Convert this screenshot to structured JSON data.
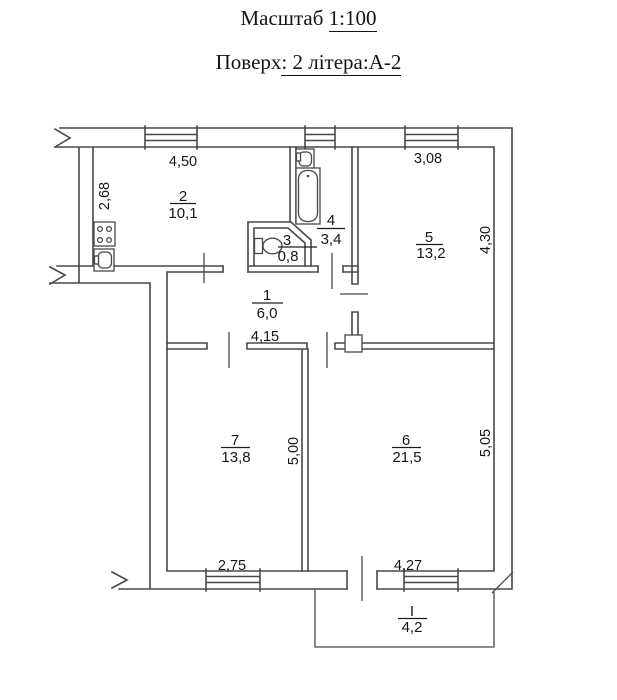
{
  "header": {
    "line1": {
      "prefix": "Масштаб",
      "underlined": "1:100"
    },
    "line2": {
      "prefix": "Поверх",
      "underlined": ": 2 літера:А-2"
    }
  },
  "rooms": [
    {
      "id": "hallway",
      "number": "1",
      "area": "6,0"
    },
    {
      "id": "kitchen",
      "number": "2",
      "area": "10,1"
    },
    {
      "id": "wc",
      "number": "3",
      "area": "0,8"
    },
    {
      "id": "bathroom",
      "number": "4",
      "area": "3,4"
    },
    {
      "id": "room-5",
      "number": "5",
      "area": "13,2"
    },
    {
      "id": "room-6",
      "number": "6",
      "area": "21,5"
    },
    {
      "id": "room-7",
      "number": "7",
      "area": "13,8"
    },
    {
      "id": "balcony",
      "number": "I",
      "area": "4,2"
    }
  ],
  "dimensions": [
    {
      "label": "4,50",
      "orientation": "horizontal",
      "location": "kitchen-top"
    },
    {
      "label": "2,68",
      "orientation": "vertical",
      "location": "kitchen-left"
    },
    {
      "label": "3,08",
      "orientation": "horizontal",
      "location": "room5-top"
    },
    {
      "label": "4,30",
      "orientation": "vertical",
      "location": "room5-right"
    },
    {
      "label": "4,15",
      "orientation": "horizontal",
      "location": "hallway-bottom"
    },
    {
      "label": "5,00",
      "orientation": "vertical",
      "location": "room7-right"
    },
    {
      "label": "5,05",
      "orientation": "vertical",
      "location": "room6-right"
    },
    {
      "label": "2,75",
      "orientation": "horizontal",
      "location": "room7-bottom"
    },
    {
      "label": "4,27",
      "orientation": "horizontal",
      "location": "room6-bottom"
    }
  ],
  "colors": {
    "line": "#484848",
    "text": "#161616",
    "background": "#ffffff"
  }
}
